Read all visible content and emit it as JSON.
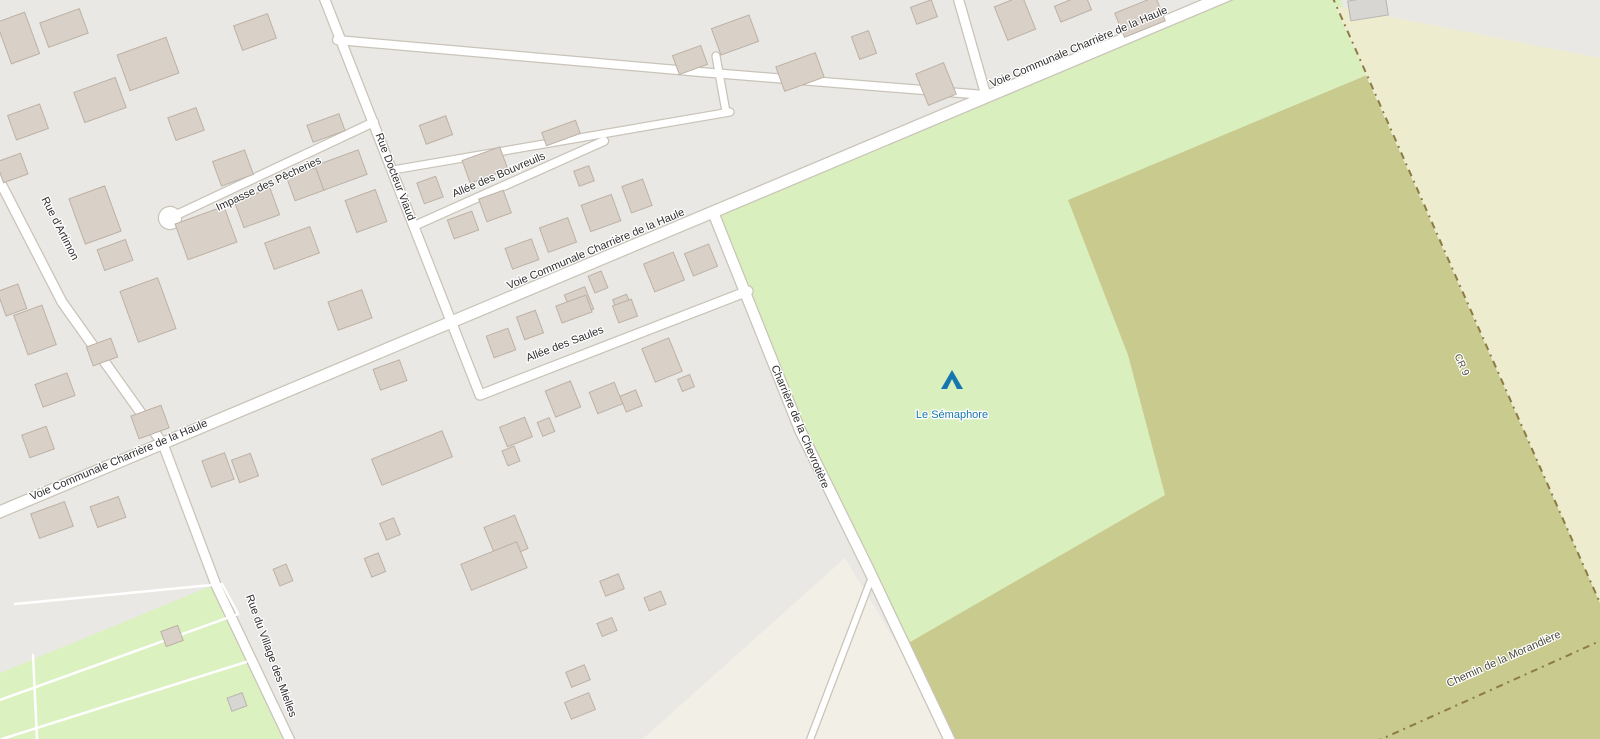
{
  "map": {
    "width": 1600,
    "height": 739,
    "colors": {
      "base_residential": "#eae8e4",
      "meadow_green": "#d9f0be",
      "campground_green": "#dcf1c0",
      "orchard_olive": "#c9ca8e",
      "farmland_cream": "#eeeccf",
      "farmyard_beige": "#f2efe6",
      "road_fill": "#ffffff",
      "road_casing": "#c9c3b8",
      "building_fill": "#d9d0c8",
      "building_stroke": "#bcb1a5",
      "gray_building_fill": "#d8d6d3",
      "gray_building_stroke": "#b8b6b2",
      "track_dash": "#8c7b45",
      "road_label": "#2e2e2e",
      "track_label": "#4c4a38",
      "poi_blue": "#1576b0",
      "label_halo": "#ffffff"
    },
    "areas": [
      {
        "name": "area-meadow",
        "color_key": "meadow_green",
        "points": [
          [
            713,
            212
          ],
          [
            1243,
            -8
          ],
          [
            1338,
            -8
          ],
          [
            1367,
            75
          ],
          [
            1068,
            200
          ],
          [
            1128,
            355
          ],
          [
            1165,
            495
          ],
          [
            905,
            645
          ],
          [
            868,
            568
          ],
          [
            800,
            430
          ]
        ]
      },
      {
        "name": "area-orchard",
        "color_key": "orchard_olive",
        "points": [
          [
            1068,
            200
          ],
          [
            1367,
            75
          ],
          [
            1600,
            603
          ],
          [
            1600,
            745
          ],
          [
            955,
            745
          ],
          [
            905,
            645
          ],
          [
            1165,
            495
          ],
          [
            1128,
            355
          ]
        ]
      },
      {
        "name": "area-farmland",
        "color_key": "farmland_cream",
        "points": [
          [
            1335,
            6
          ],
          [
            1600,
            58
          ],
          [
            1600,
            603
          ]
        ]
      },
      {
        "name": "area-farmyard",
        "color_key": "farmyard_beige",
        "points": [
          [
            845,
            558
          ],
          [
            958,
            745
          ],
          [
            636,
            745
          ]
        ]
      },
      {
        "name": "area-campground",
        "color_key": "campground_green",
        "points": [
          [
            0,
            673
          ],
          [
            218,
            583
          ],
          [
            292,
            745
          ],
          [
            0,
            745
          ]
        ]
      }
    ],
    "roads": [
      {
        "name": "road-voie-communale-charriere-haule",
        "width": 11,
        "points": [
          [
            -10,
            516
          ],
          [
            713,
            212
          ],
          [
            1245,
            -12
          ]
        ]
      },
      {
        "name": "road-charriere-chevrotiere",
        "width": 10,
        "points": [
          [
            713,
            212
          ],
          [
            800,
            430
          ],
          [
            868,
            568
          ],
          [
            952,
            745
          ]
        ]
      },
      {
        "name": "road-rue-docteur-viaud",
        "width": 9,
        "points": [
          [
            323,
            -5
          ],
          [
            480,
            395
          ]
        ]
      },
      {
        "name": "road-allee-des-saules",
        "width": 9,
        "points": [
          [
            480,
            395
          ],
          [
            748,
            291
          ]
        ]
      },
      {
        "name": "road-impasse-des-pecheries",
        "width": 8,
        "points": [
          [
            170,
            218
          ],
          [
            374,
            122
          ]
        ]
      },
      {
        "name": "road-allee-des-bouvreuils",
        "width": 8,
        "points": [
          [
            414,
            226
          ],
          [
            604,
            141
          ]
        ]
      },
      {
        "name": "road-rue-artimon-mielles",
        "width": 9,
        "points": [
          [
            -5,
            172
          ],
          [
            62,
            302
          ],
          [
            163,
            444
          ],
          [
            216,
            585
          ],
          [
            292,
            745
          ]
        ]
      },
      {
        "name": "road-top-street",
        "width": 8,
        "points": [
          [
            337,
            40
          ],
          [
            700,
            72
          ],
          [
            985,
            95
          ]
        ]
      },
      {
        "name": "road-top-vertical",
        "width": 9,
        "points": [
          [
            957,
            -6
          ],
          [
            985,
            92
          ]
        ]
      },
      {
        "name": "road-mid-street",
        "width": 7,
        "points": [
          [
            393,
            170
          ],
          [
            730,
            112
          ]
        ]
      },
      {
        "name": "road-mid-connector",
        "width": 7,
        "points": [
          [
            726,
            112
          ],
          [
            716,
            56
          ]
        ]
      },
      {
        "name": "road-south-spur",
        "width": 6,
        "points": [
          [
            870,
            582
          ],
          [
            808,
            745
          ]
        ]
      }
    ],
    "culdesac": {
      "x": 170,
      "y": 218,
      "r": 11
    },
    "service_paths": [
      [
        [
          15,
          604
        ],
        [
          222,
          584
        ]
      ],
      [
        [
          0,
          700
        ],
        [
          238,
          614
        ]
      ],
      [
        [
          2,
          739
        ],
        [
          246,
          662
        ]
      ],
      [
        [
          222,
          584
        ],
        [
          238,
          614
        ]
      ],
      [
        [
          33,
          655
        ],
        [
          37,
          739
        ]
      ]
    ],
    "tracks": [
      {
        "name": "track-cr9",
        "points": [
          [
            1332,
            -4
          ],
          [
            1600,
            603
          ]
        ]
      },
      {
        "name": "track-morandiere",
        "points": [
          [
            1375,
            742
          ],
          [
            1600,
            641
          ]
        ]
      }
    ],
    "buildings": [
      [
        18,
        38,
        30,
        44,
        -20
      ],
      [
        64,
        28,
        42,
        26,
        -20
      ],
      [
        100,
        100,
        44,
        32,
        -20
      ],
      [
        148,
        64,
        52,
        38,
        -20
      ],
      [
        186,
        124,
        30,
        24,
        -20
      ],
      [
        28,
        122,
        34,
        26,
        -20
      ],
      [
        12,
        168,
        26,
        22,
        -20
      ],
      [
        255,
        32,
        36,
        26,
        -20
      ],
      [
        233,
        168,
        34,
        26,
        -20
      ],
      [
        306,
        184,
        32,
        24,
        -20
      ],
      [
        341,
        170,
        46,
        26,
        -20
      ],
      [
        436,
        130,
        28,
        20,
        -20
      ],
      [
        326,
        128,
        34,
        18,
        -20
      ],
      [
        561,
        133,
        36,
        14,
        -20
      ],
      [
        690,
        60,
        30,
        20,
        -20
      ],
      [
        257,
        208,
        38,
        28,
        -20
      ],
      [
        206,
        233,
        52,
        38,
        -20
      ],
      [
        292,
        248,
        48,
        28,
        -20
      ],
      [
        366,
        211,
        32,
        34,
        -20
      ],
      [
        95,
        215,
        38,
        48,
        -20
      ],
      [
        35,
        330,
        30,
        42,
        -20
      ],
      [
        12,
        300,
        22,
        26,
        -20
      ],
      [
        115,
        255,
        30,
        22,
        -20
      ],
      [
        148,
        310,
        40,
        54,
        -20
      ],
      [
        55,
        390,
        34,
        24,
        -20
      ],
      [
        102,
        352,
        26,
        20,
        -20
      ],
      [
        38,
        442,
        26,
        24,
        -20
      ],
      [
        150,
        422,
        32,
        24,
        -20
      ],
      [
        218,
        470,
        24,
        28,
        -20
      ],
      [
        52,
        520,
        36,
        26,
        -20
      ],
      [
        108,
        512,
        30,
        22,
        -20
      ],
      [
        485,
        165,
        40,
        24,
        -20
      ],
      [
        430,
        190,
        20,
        22,
        -20
      ],
      [
        495,
        206,
        26,
        24,
        -20
      ],
      [
        584,
        176,
        16,
        16,
        -20
      ],
      [
        637,
        196,
        22,
        28,
        -20
      ],
      [
        601,
        213,
        32,
        28,
        -20
      ],
      [
        463,
        225,
        26,
        20,
        -20
      ],
      [
        558,
        235,
        30,
        26,
        -20
      ],
      [
        522,
        254,
        28,
        22,
        -20
      ],
      [
        664,
        272,
        32,
        30,
        -22
      ],
      [
        701,
        260,
        26,
        24,
        -22
      ],
      [
        598,
        282,
        14,
        18,
        -22
      ],
      [
        579,
        302,
        22,
        24,
        -22
      ],
      [
        622,
        303,
        15,
        13,
        -22
      ],
      [
        350,
        310,
        36,
        30,
        -20
      ],
      [
        501,
        343,
        23,
        23,
        -20
      ],
      [
        530,
        325,
        20,
        24,
        -20
      ],
      [
        574,
        309,
        32,
        18,
        -20
      ],
      [
        625,
        311,
        20,
        18,
        -20
      ],
      [
        662,
        360,
        29,
        36,
        -22
      ],
      [
        686,
        383,
        13,
        13,
        -22
      ],
      [
        563,
        399,
        27,
        28,
        -22
      ],
      [
        606,
        398,
        27,
        23,
        -22
      ],
      [
        631,
        401,
        17,
        17,
        -22
      ],
      [
        390,
        375,
        28,
        22,
        -20
      ],
      [
        245,
        468,
        20,
        24,
        -20
      ],
      [
        412,
        458,
        76,
        28,
        -22
      ],
      [
        516,
        432,
        27,
        21,
        -22
      ],
      [
        511,
        456,
        13,
        16,
        -22
      ],
      [
        546,
        427,
        13,
        15,
        -22
      ],
      [
        390,
        529,
        15,
        18,
        -22
      ],
      [
        375,
        565,
        15,
        20,
        -22
      ],
      [
        506,
        538,
        33,
        36,
        -22
      ],
      [
        494,
        566,
        60,
        28,
        -22
      ],
      [
        612,
        585,
        20,
        16,
        -22
      ],
      [
        655,
        601,
        18,
        14,
        -22
      ],
      [
        607,
        627,
        16,
        14,
        -22
      ],
      [
        578,
        676,
        20,
        16,
        -22
      ],
      [
        580,
        706,
        26,
        18,
        -22
      ],
      [
        283,
        575,
        14,
        18,
        -22
      ],
      [
        735,
        35,
        40,
        28,
        -20
      ],
      [
        800,
        72,
        42,
        26,
        -20
      ],
      [
        864,
        45,
        18,
        24,
        -20
      ],
      [
        924,
        12,
        22,
        18,
        -20
      ],
      [
        936,
        84,
        30,
        34,
        -22
      ],
      [
        1015,
        18,
        30,
        36,
        -22
      ],
      [
        1073,
        8,
        33,
        17,
        -22
      ],
      [
        1140,
        17,
        44,
        26,
        -22
      ],
      [
        172,
        636,
        18,
        16,
        -20
      ]
    ],
    "gray_buildings": [
      [
        1368,
        8,
        38,
        20,
        -9
      ],
      [
        237,
        702,
        16,
        14,
        -20
      ]
    ],
    "labels": [
      {
        "name": "label-impasse-pecheries",
        "text": "Impasse des Pêcheries",
        "x": 270,
        "y": 187,
        "rot": -25,
        "size": 11,
        "color_key": "road_label"
      },
      {
        "name": "label-rue-docteur-viaud",
        "text": "Rue Docteur Viaud",
        "x": 392,
        "y": 178,
        "rot": 69,
        "size": 11,
        "color_key": "road_label"
      },
      {
        "name": "label-allee-bouvreuils",
        "text": "Allée des Bouvreuils",
        "x": 500,
        "y": 178,
        "rot": -23,
        "size": 11,
        "color_key": "road_label"
      },
      {
        "name": "label-voie-communale-center",
        "text": "Voie Communale Charrière de la Haule",
        "x": 597,
        "y": 252,
        "rot": -23,
        "size": 11,
        "color_key": "road_label"
      },
      {
        "name": "label-voie-communale-left",
        "text": "Voie Communale Charrière de la Haule",
        "x": 120,
        "y": 463,
        "rot": -23,
        "size": 11,
        "color_key": "road_label"
      },
      {
        "name": "label-voie-communale-topright",
        "text": "Voie Communale Charrière de la Haule",
        "x": 1080,
        "y": 50,
        "rot": -23,
        "size": 11,
        "color_key": "road_label"
      },
      {
        "name": "label-allee-saules",
        "text": "Allée des Saules",
        "x": 566,
        "y": 347,
        "rot": -21,
        "size": 11,
        "color_key": "road_label"
      },
      {
        "name": "label-charriere-chevrotiere",
        "text": "Charrière de la Chevrotière",
        "x": 797,
        "y": 428,
        "rot": 67,
        "size": 11,
        "color_key": "road_label"
      },
      {
        "name": "label-rue-artimon",
        "text": "Rue d'Artimon",
        "x": 57,
        "y": 230,
        "rot": 63,
        "size": 11,
        "color_key": "road_label"
      },
      {
        "name": "label-rue-village-mielles",
        "text": "Rue du Village des Mielles",
        "x": 268,
        "y": 657,
        "rot": 70,
        "size": 11,
        "color_key": "road_label"
      },
      {
        "name": "label-cr9",
        "text": "CR 9",
        "x": 1459,
        "y": 366,
        "rot": 66,
        "size": 10,
        "color_key": "track_label"
      },
      {
        "name": "label-chemin-morandiere",
        "text": "Chemin de la Morandière",
        "x": 1505,
        "y": 662,
        "rot": -24,
        "size": 11,
        "color_key": "track_label"
      }
    ],
    "poi": {
      "name": "poi-le-semaphore",
      "label": "Le Sémaphore",
      "x": 952,
      "y": 404,
      "icon": "campsite-tent-icon",
      "icon_x": 952,
      "icon_y": 380
    }
  }
}
